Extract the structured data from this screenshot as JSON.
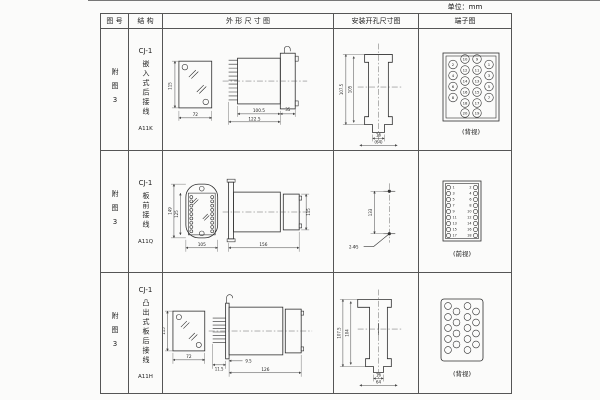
{
  "page": {
    "unit_label": "单位：mm"
  },
  "header": {
    "figure_col": "图 号",
    "structure_col": "结 构",
    "outline_col": "外 形 尺 寸 图",
    "install_col": "安装开孔尺寸图",
    "terminal_col": "端子图"
  },
  "rows": [
    {
      "figure_no": "附图3",
      "model": "CJ-1",
      "structure_name": "嵌入式后接线",
      "code": "A11K",
      "outline": {
        "front_height": "115",
        "front_width": "72",
        "body_depth": "100.5",
        "total_depth": "122.5",
        "flange_depth": "35"
      },
      "install": {
        "outer_height": "107.5",
        "inner_height": "105",
        "slot_width": "16",
        "hole_span": "(64)"
      },
      "terminal": {
        "view_label": "(背视)",
        "numbers": [
          "2",
          "4",
          "6",
          "8",
          "10",
          "12",
          "14",
          "16",
          "18",
          "9",
          "11",
          "13",
          "15",
          "17",
          "1",
          "3",
          "5",
          "7",
          "20",
          "19"
        ]
      }
    },
    {
      "figure_no": "附图3",
      "model": "CJ-1",
      "structure_name": "板前接线",
      "code": "A11Q",
      "outline": {
        "front_outer_height": "149",
        "front_inner_height": "125",
        "front_width": "105",
        "side_length": "156",
        "side_height": "115"
      },
      "install": {
        "hole_spacing": "133",
        "hole_note": "2-Φ5"
      },
      "terminal": {
        "view_label": "(前视)",
        "left_numbers": [
          "1",
          "3",
          "5",
          "7",
          "9",
          "11",
          "13",
          "15",
          "17"
        ],
        "right_numbers": [
          "2",
          "4",
          "6",
          "8",
          "10",
          "12",
          "14",
          "16",
          "18"
        ]
      }
    },
    {
      "figure_no": "附图3",
      "model": "CJ-1",
      "structure_name": "凸出式板后接线",
      "code": "A11H",
      "outline": {
        "front_height": "115",
        "front_width": "72",
        "pin_depth": "11.5",
        "offset": "9.5",
        "body_depth": "126"
      },
      "install": {
        "outer_height": "107.5",
        "inner_height": "104",
        "slot_width": "16",
        "hole_span": "64"
      },
      "terminal": {
        "view_label": "(背视)"
      }
    }
  ]
}
